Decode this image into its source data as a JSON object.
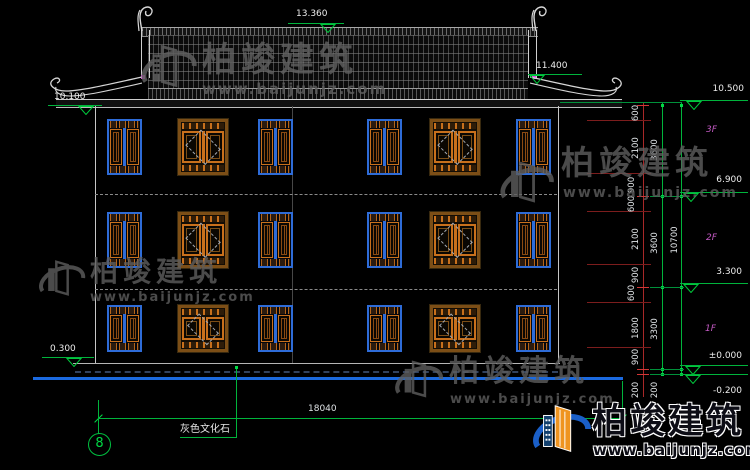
{
  "brand": {
    "name": "柏竣建筑",
    "site": "www.baijunjz.com"
  },
  "elevations": {
    "ridge": "13.360",
    "eave_right": "11.400",
    "eave_left": "10.100",
    "wall_top": "10.500",
    "floor3": "6.900",
    "floor2": "3.300",
    "floor1": "±0.000",
    "ground": "-0.200",
    "plinth": "0.300"
  },
  "dimensions": {
    "segments": [
      "600",
      "2100",
      "900",
      "600",
      "2100",
      "900",
      "600",
      "1800",
      "900",
      "200"
    ],
    "floors": [
      "3600",
      "3600",
      "3300",
      "200"
    ],
    "total_height": "10700",
    "total_width": "18040"
  },
  "labels": {
    "floor3": "3F",
    "floor2": "2F",
    "floor1": "1F",
    "axis": "8",
    "material": "灰色文化石"
  },
  "colors": {
    "dim_green": "#00b43c",
    "dim_red": "#c03434",
    "window_blue": "#2e6cd8",
    "window_orange": "#c8701c",
    "ground_blue": "#1b6ae0",
    "label_magenta": "#c45ac4"
  }
}
